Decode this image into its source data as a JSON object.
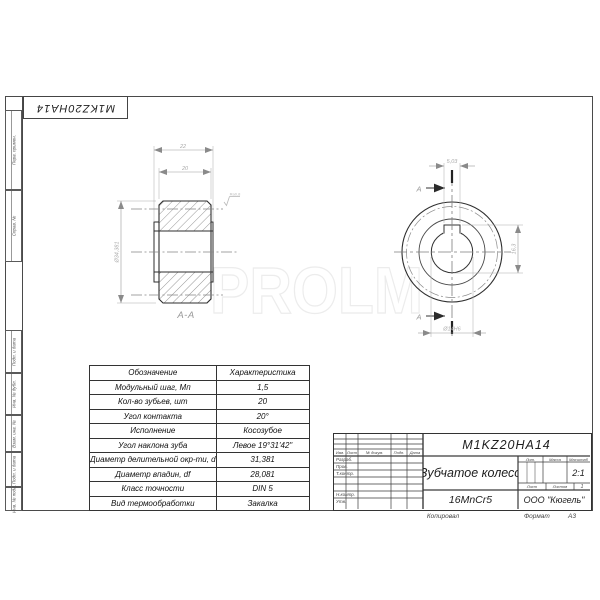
{
  "watermark": "PROLM",
  "corner_designation": "M1KZ20HA14",
  "margin_labels": [
    "Перв. примен.",
    "Справ. №",
    "Подп. и дата",
    "Инв. № дубл.",
    "Взам. инв. №",
    "Подп. и дата",
    "Инв. № подл."
  ],
  "drawing": {
    "section_label": "А-А",
    "cut_letter": "А",
    "dims": {
      "overall_width": "22",
      "face_width": "20",
      "outer_dia": "Ø34,381",
      "keyway_width": "5,03",
      "keyway_depth": "16,3",
      "bore": "Ø14H6"
    },
    "roughness": "Ra0,8"
  },
  "spec_table": {
    "headers": [
      "Обозначение",
      "Характеристика"
    ],
    "rows": [
      [
        "Модульный шаг, Мп",
        "1,5"
      ],
      [
        "Кол-во зубьев, шт",
        "20"
      ],
      [
        "Угол контакта",
        "20°"
      ],
      [
        "Исполнение",
        "Косозубое"
      ],
      [
        "Угол наклона зуба",
        "Левое 19°31'42\""
      ],
      [
        "Диаметр делительной окр-ти, d",
        "31,381"
      ],
      [
        "Диаметр впадин, df",
        "28,081"
      ],
      [
        "Класс точности",
        "DIN 5"
      ],
      [
        "Вид термообработки",
        "Закалка"
      ]
    ]
  },
  "title_block": {
    "designation": "M1KZ20HA14",
    "part_name": "Зубчатое колесо",
    "material": "16MnCr5",
    "company": "ООО \"Кюгель\"",
    "scale_value": "2:1",
    "labels": {
      "izm": "Изм.",
      "list_col": "Лист",
      "n_dokum": "№ докум.",
      "podp": "Подп.",
      "data": "Дата",
      "lit": "Лит.",
      "massa": "Масса",
      "masshtab": "Масштаб",
      "list": "Лист",
      "listov": "Листов",
      "listov_value": "1"
    },
    "roles": [
      "Разраб.",
      "Пров.",
      "Т.контр.",
      "Н.контр.",
      "Утв."
    ],
    "footer": {
      "copied": "Копировал",
      "format_label": "Формат",
      "format_value": "А3"
    }
  }
}
